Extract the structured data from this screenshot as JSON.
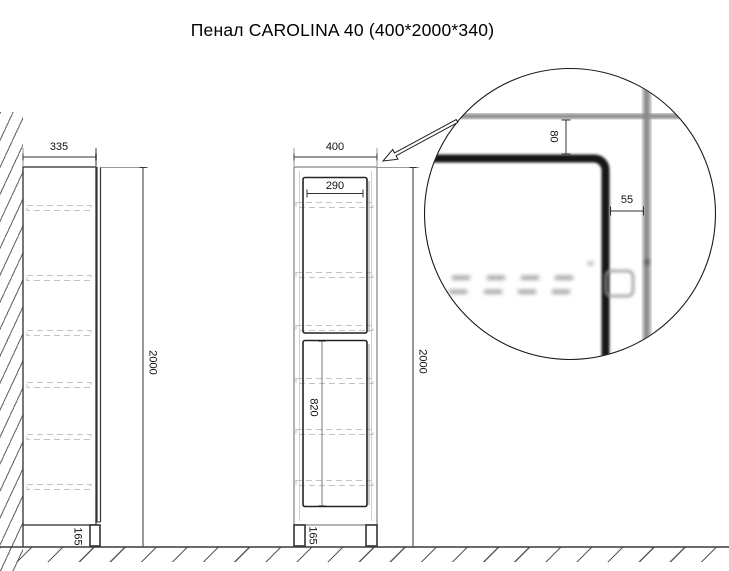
{
  "title": "Пенал CAROLINA 40 (400*2000*340)",
  "side_view": {
    "depth_dim": "335",
    "height_dim": "2000",
    "plinth_dim": "165"
  },
  "front_view": {
    "width_dim": "400",
    "door_width_dim": "290",
    "lower_door_height_dim": "820",
    "height_dim": "2000",
    "plinth_dim": "165"
  },
  "detail_view": {
    "top_reveal_dim": "80",
    "side_reveal_dim": "55"
  }
}
